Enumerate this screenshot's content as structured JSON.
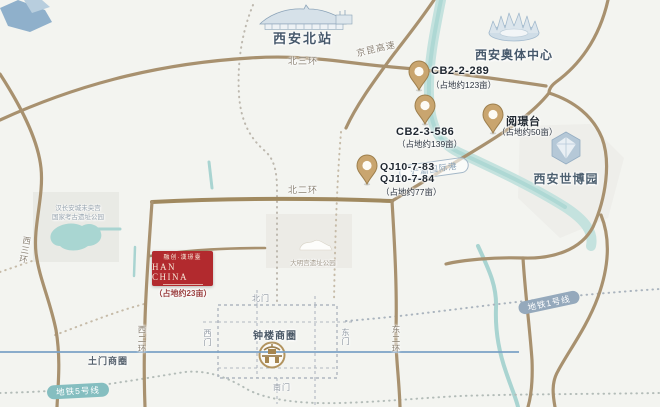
{
  "landmarks": {
    "north_station": "西安北站",
    "olympic_center": "西安奥体中心",
    "expo_park": "西安世博园",
    "bell_tower_district": "钟楼商圈",
    "tumen_district": "土门商圈",
    "hancheng_park_line1": "汉长安城未央宫",
    "hancheng_park_line2": "国家考古遗址公园",
    "daming_palace_park": "大明宫遗址公园",
    "chanba_port": "浐灞国际港"
  },
  "roads": {
    "north_third_ring": "北三环",
    "jingkun_expressway": "京昆高速",
    "north_second_ring": "北二环",
    "west_third_ring": "西三环",
    "west_second_ring": "西二环",
    "east_second_ring": "东二环"
  },
  "gates": {
    "north": "北门",
    "south": "南门",
    "west": "西门",
    "east": "东门"
  },
  "metro": {
    "line1_label": "地铁1号线",
    "line5_label": "地铁5号线"
  },
  "pins": [
    {
      "name": "CB2-2-289",
      "area": "（占地约123亩）"
    },
    {
      "name": "CB2-3-586",
      "area": "（占地约139亩）"
    },
    {
      "name": "阅璟台",
      "area": "（占地约50亩）"
    },
    {
      "name": "QJ10-7-83",
      "name2": "QJ10-7-84",
      "area": "（占地约77亩）"
    }
  ],
  "project": {
    "brand_cn": "融创·漢璟臺",
    "brand_en": "HAN CHINA",
    "area": "（占地约23亩）"
  },
  "colors": {
    "road": "#a8916f",
    "river": "#b9dcd8",
    "metro_line1": "#7ba2c6",
    "pin_fill": "#c9a56f",
    "accent_red": "#b22a2e",
    "label_blue": "#46586b"
  }
}
